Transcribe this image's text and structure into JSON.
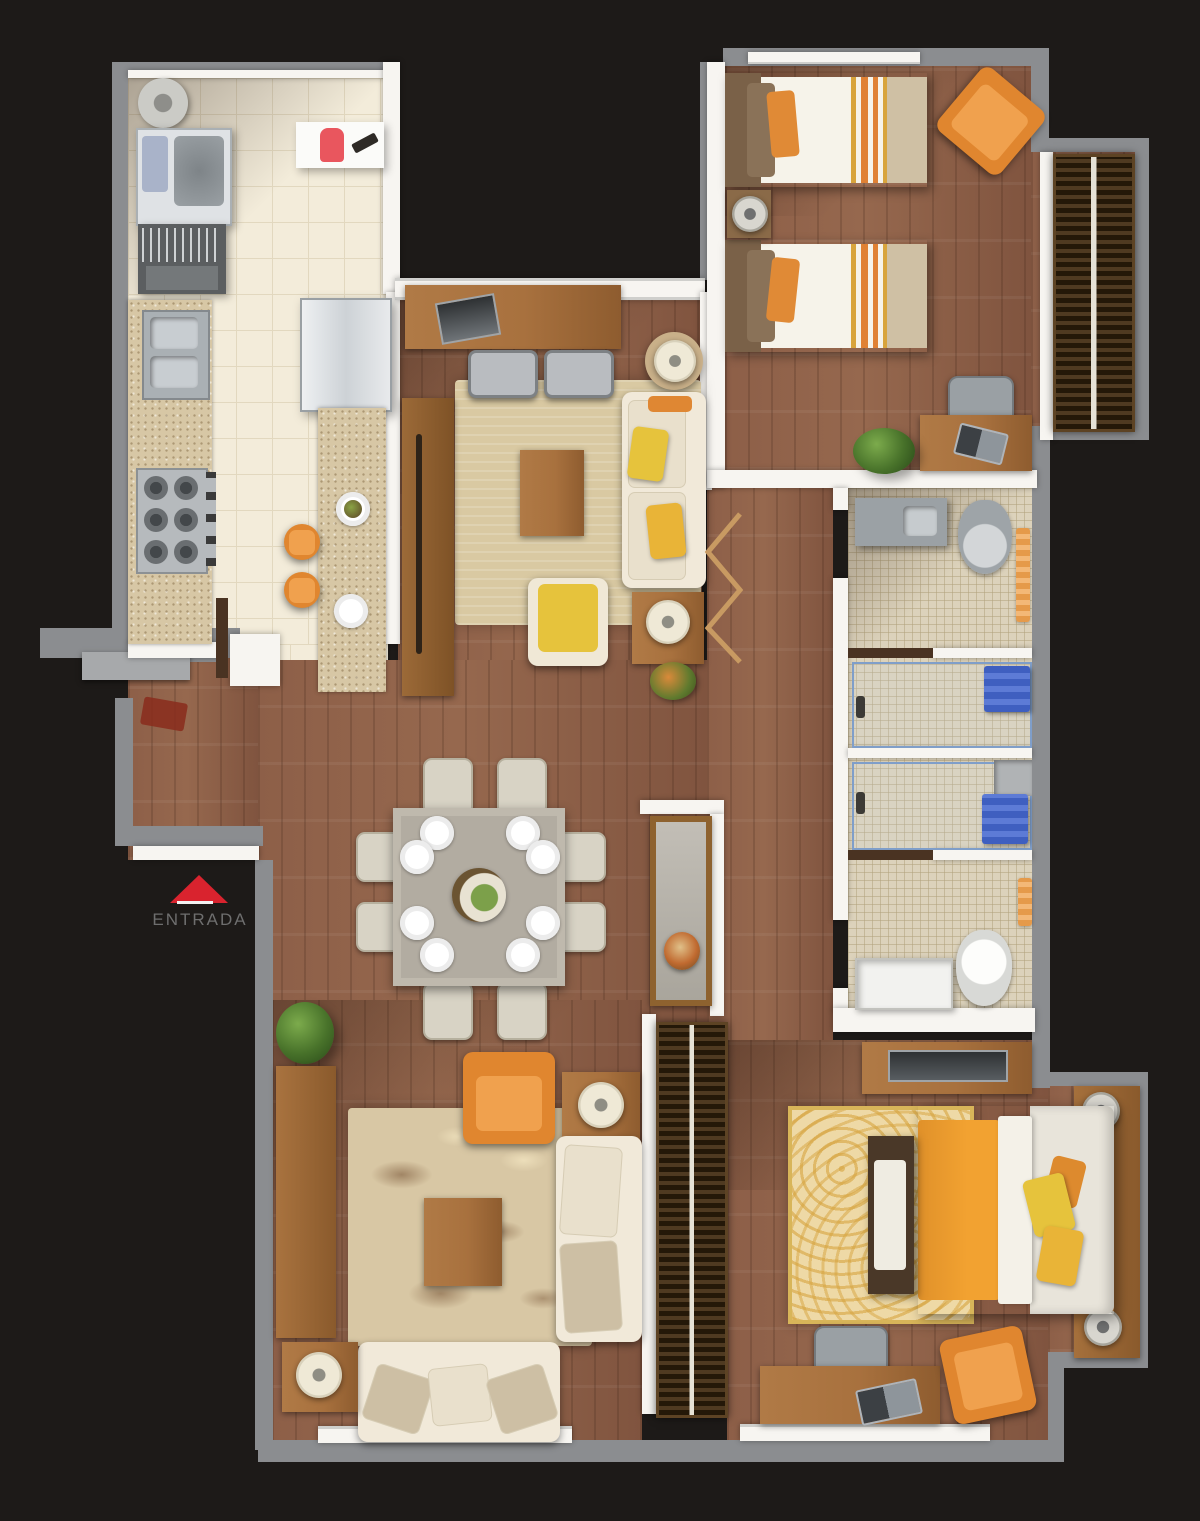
{
  "plan_type": "apartment-floor-plan-top-view",
  "entrance": {
    "label": "ENTRADA",
    "triangle_color": "#d9232e",
    "label_color": "#6e6e6e"
  },
  "palette": {
    "background": "#1d1a18",
    "outer_wall": "#8b8d90",
    "inner_wall": "#f7f5f1",
    "wood_floor": "#96684e",
    "furniture_wood": "#a8713e",
    "kitchen_tile": "#f3ecda",
    "tile_grout": "#e2d8bf",
    "bath_mosaic": "#dcd2bb",
    "granite_counter": "#d7c7a5",
    "rug_beige": "#d9c9a2",
    "rug_floral": "#d8c7a4",
    "rug_master": "#eed9a6",
    "sofa_cream": "#f1e9d9",
    "accent_yellow": "#e6c33c",
    "accent_orange": "#e0862f",
    "bed_orange": "#f2a231",
    "towel_blue": "#3f5fc0",
    "dining_table": "#b2aca1",
    "closet_dark": "#33261a"
  },
  "rooms": [
    {
      "id": "laundry-room",
      "items": [
        "water-heater",
        "washing-machine",
        "utility-rack",
        "wall-shelf",
        "fire-extinguisher",
        "hand-brush"
      ]
    },
    {
      "id": "kitchen",
      "items": [
        "double-sink",
        "gas-stove",
        "refrigerator",
        "island-counter",
        "bar-stool",
        "bar-stool",
        "plate-setting",
        "plate-setting",
        "door-leaf"
      ]
    },
    {
      "id": "living-room",
      "items": [
        "media-sideboard",
        "tv-panel",
        "lounge-chair",
        "lounge-chair",
        "round-lamp-table",
        "area-rug",
        "coffee-table",
        "sofa",
        "armchair-yellow",
        "side-table-lamp",
        "flower-pot",
        "tall-cabinet",
        "accordion-divider"
      ]
    },
    {
      "id": "dining-room",
      "items": [
        "dining-table",
        "dining-chair",
        "dining-chair",
        "dining-chair",
        "dining-chair",
        "dining-chair",
        "dining-chair",
        "dining-chair",
        "dining-chair",
        "centerpiece",
        "plant"
      ]
    },
    {
      "id": "bedroom-twin",
      "items": [
        "twin-bed",
        "twin-bed",
        "nightstand",
        "bedside-lamp",
        "armchair-orange",
        "wardrobe",
        "desk",
        "desk-chair",
        "laptop",
        "plant",
        "window"
      ]
    },
    {
      "id": "bathroom-1",
      "items": [
        "vanity-sink",
        "toilet",
        "shower",
        "towel-blue",
        "towels-orange"
      ]
    },
    {
      "id": "bathroom-2",
      "items": [
        "vanity-sink",
        "toilet",
        "shower",
        "towel-blue",
        "towels-orange"
      ]
    },
    {
      "id": "hallway",
      "items": [
        "console-table",
        "flower-bowl",
        "built-in-closet"
      ]
    },
    {
      "id": "family-room",
      "items": [
        "plant",
        "side-cabinet",
        "armchair-orange",
        "floral-rug",
        "coffee-table",
        "sofa",
        "sofa",
        "side-table-lamp",
        "side-table-lamp",
        "side-table-lamp",
        "window"
      ]
    },
    {
      "id": "master-bedroom",
      "items": [
        "tv-console",
        "double-bed",
        "bench",
        "spiral-rug",
        "bedside-lamp",
        "bedside-lamp",
        "desk",
        "desk-chair",
        "laptop",
        "armchair-orange",
        "window"
      ]
    },
    {
      "id": "entry-hall",
      "items": [
        "entrance-door",
        "doormat"
      ]
    }
  ]
}
